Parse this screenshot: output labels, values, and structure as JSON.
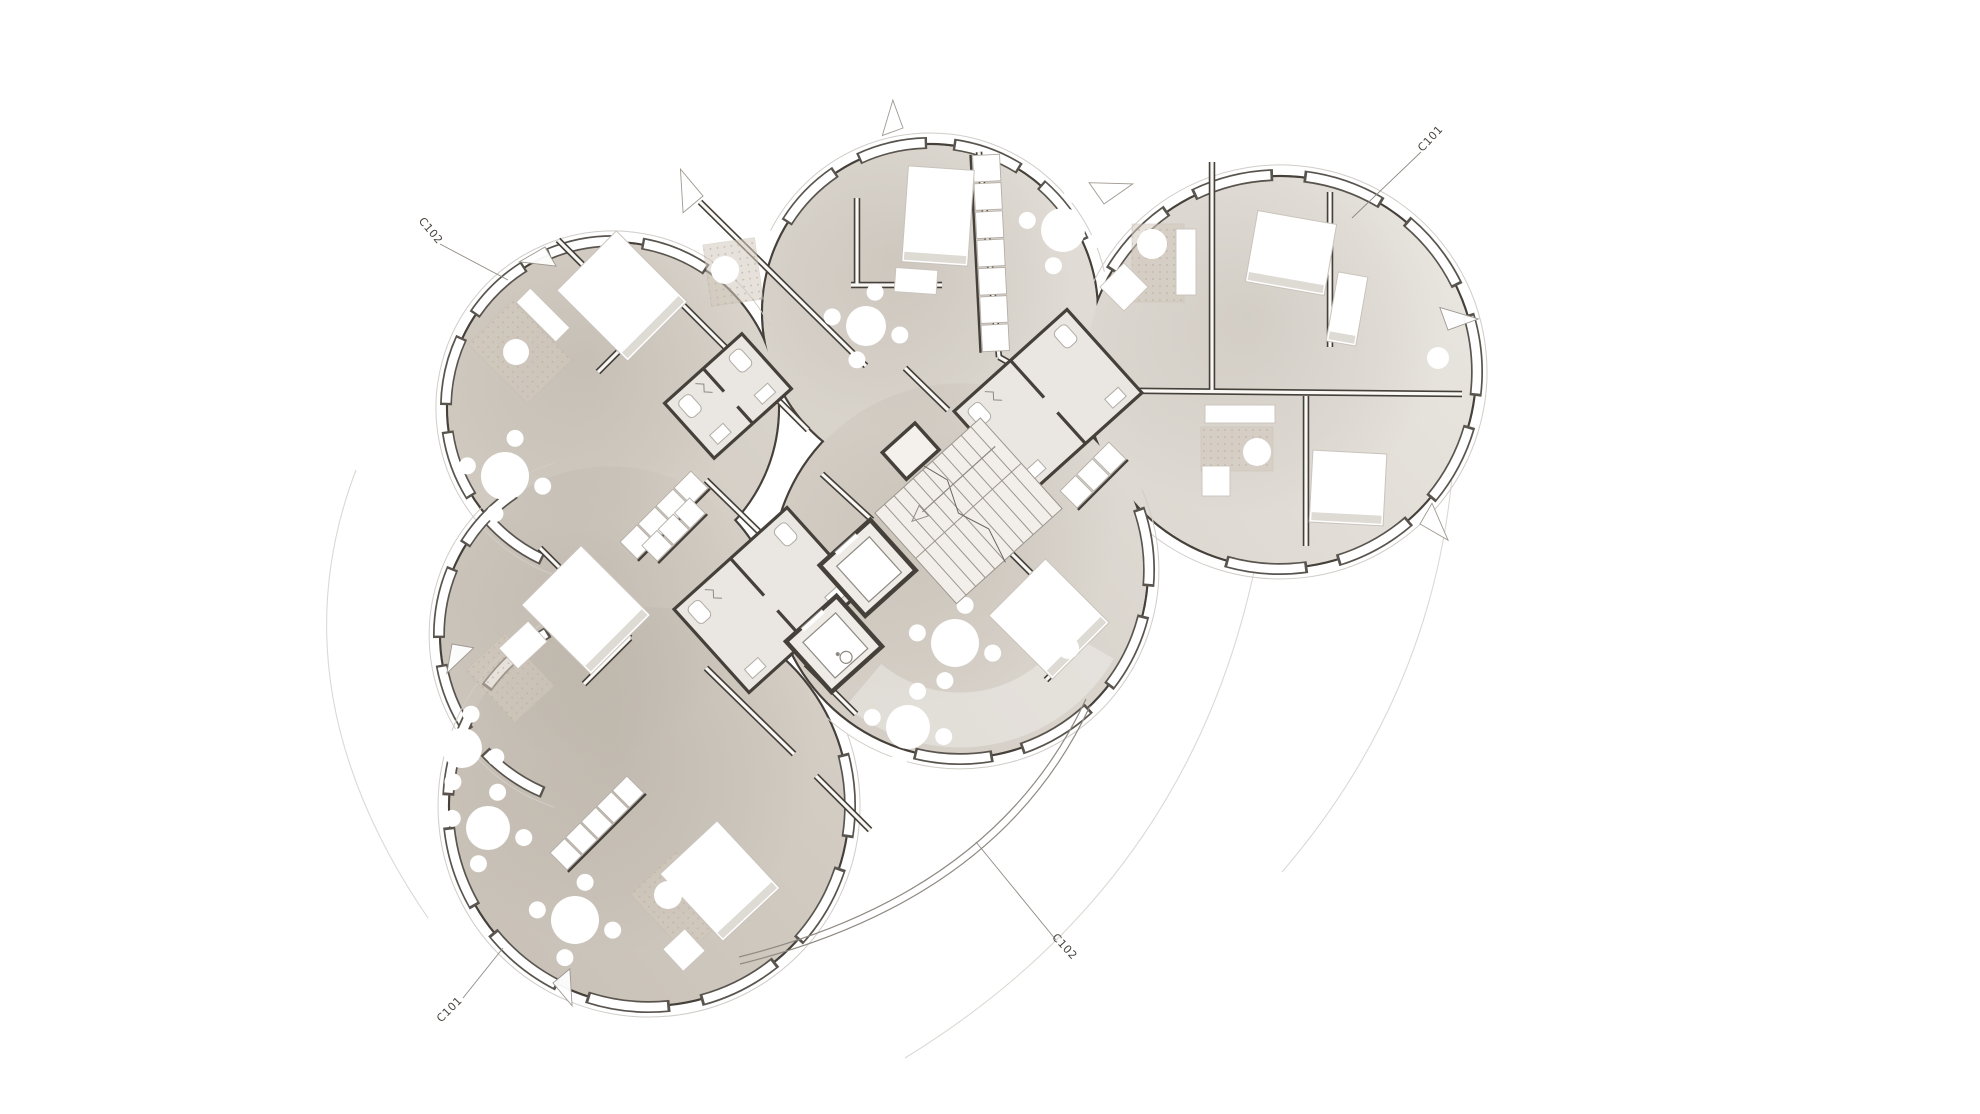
{
  "drawing": {
    "type": "architectural-floor-plan",
    "callouts": [
      {
        "text": "C101",
        "x": 1433,
        "y": 141,
        "rot": -47,
        "leader": [
          1352,
          218,
          1421,
          152
        ]
      },
      {
        "text": "C102",
        "x": 428,
        "y": 233,
        "rot": 50,
        "leader": [
          440,
          244,
          508,
          280
        ]
      },
      {
        "text": "C101",
        "x": 452,
        "y": 1012,
        "rot": -45,
        "leader": [
          463,
          998,
          503,
          948
        ]
      },
      {
        "text": "C102",
        "x": 1062,
        "y": 949,
        "rot": 47,
        "leader": [
          976,
          842,
          1056,
          940
        ]
      }
    ],
    "colors": {
      "wall": "#45403a",
      "line": "#8f8a83",
      "floor_dark": "#c4bcb1",
      "floor_light": "#ece9e4",
      "white": "#ffffff",
      "carpet": "#d3cabe",
      "carpet_dot": "#b8ad9c",
      "ghost": "#dcd9d4",
      "furniture_stroke": "#c9c3bb",
      "fixture_stroke": "#b2aca4",
      "bath_floor": "#eae6e1",
      "wall_fill": "#faf8f4",
      "outer_ring": "#d0cdc8",
      "text": "#4a4540"
    },
    "pods": [
      {
        "cx": 613,
        "cy": 408,
        "r": 166,
        "exp": [
          110,
          332
        ]
      },
      {
        "cx": 930,
        "cy": 312,
        "r": 168,
        "exp": [
          207,
          347
        ]
      },
      {
        "cx": 1280,
        "cy": 372,
        "r": 196,
        "exp": [
          206,
          492
        ]
      },
      {
        "cx": 610,
        "cy": 635,
        "r": 170,
        "exp": [
          108,
          252
        ]
      },
      {
        "cx": 649,
        "cy": 806,
        "r": 200,
        "exp": [
          340,
          600
        ]
      },
      {
        "cx": 960,
        "cy": 570,
        "r": 188,
        "exp": [
          336,
          496
        ]
      }
    ],
    "commons_glow": {
      "cx": 960,
      "cy": 570,
      "r": 150,
      "start": 30,
      "end": 130
    },
    "walls": [
      [
        700,
        202,
        866,
        366
      ],
      [
        640,
        262,
        728,
        350
      ],
      [
        752,
        374,
        808,
        430
      ],
      [
        558,
        240,
        644,
        326
      ],
      [
        644,
        326,
        598,
        372
      ],
      [
        857,
        198,
        857,
        285
      ],
      [
        851,
        285,
        942,
        285
      ],
      [
        905,
        368,
        948,
        410
      ],
      [
        979,
        152,
        999,
        357
      ],
      [
        999,
        357,
        1058,
        390
      ],
      [
        1058,
        390,
        1462,
        394
      ],
      [
        1212,
        162,
        1212,
        392
      ],
      [
        1306,
        396,
        1306,
        546
      ],
      [
        1330,
        192,
        1330,
        347
      ],
      [
        948,
        468,
        1010,
        416
      ],
      [
        822,
        474,
        872,
        520
      ],
      [
        776,
        518,
        826,
        564
      ],
      [
        706,
        480,
        788,
        560
      ],
      [
        540,
        548,
        630,
        638
      ],
      [
        630,
        638,
        584,
        684
      ],
      [
        706,
        668,
        794,
        754
      ],
      [
        816,
        776,
        870,
        830
      ],
      [
        996,
        538,
        1092,
        634
      ],
      [
        1092,
        634,
        1046,
        680
      ],
      [
        806,
        664,
        856,
        714
      ]
    ],
    "wardrobes": [
      [
        986,
        154,
        996,
        352,
        7,
        27
      ],
      [
        628,
        551,
        700,
        479,
        4,
        24
      ],
      [
        558,
        862,
        636,
        784,
        5,
        24
      ],
      [
        649,
        554,
        698,
        505,
        3,
        22
      ],
      [
        1068,
        500,
        1118,
        450,
        3,
        24
      ]
    ],
    "beds": [
      [
        622,
        296,
        84,
        100,
        -45
      ],
      [
        938,
        216,
        66,
        96,
        4
      ],
      [
        1291,
        253,
        80,
        72,
        10
      ],
      [
        1347,
        309,
        30,
        70,
        10
      ],
      [
        1348,
        488,
        74,
        72,
        3
      ],
      [
        586,
        610,
        84,
        98,
        -45
      ],
      [
        720,
        881,
        78,
        92,
        -43
      ],
      [
        1049,
        619,
        80,
        90,
        -45
      ]
    ],
    "desks": [
      [
        543,
        315,
        20,
        56,
        -45
      ],
      [
        1186,
        262,
        20,
        66,
        0
      ],
      [
        1240,
        414,
        70,
        18,
        0
      ],
      [
        1216,
        481,
        28,
        30,
        0
      ],
      [
        916,
        281,
        42,
        24,
        4
      ],
      [
        684,
        950,
        30,
        30,
        -43
      ],
      [
        523,
        645,
        40,
        28,
        -43
      ],
      [
        1124,
        287,
        34,
        34,
        45
      ]
    ],
    "tables": [
      [
        1063,
        230,
        22
      ],
      [
        866,
        326,
        20
      ],
      [
        505,
        476,
        24
      ],
      [
        488,
        828,
        22
      ],
      [
        575,
        920,
        24
      ],
      [
        955,
        643,
        24
      ],
      [
        908,
        727,
        22
      ],
      [
        462,
        748,
        20
      ],
      [
        725,
        270,
        14
      ],
      [
        1152,
        244,
        15
      ],
      [
        1257,
        452,
        14
      ],
      [
        1438,
        358,
        11
      ],
      [
        668,
        895,
        14
      ],
      [
        516,
        352,
        13
      ],
      [
        1068,
        648,
        11
      ]
    ],
    "carpets": [
      [
        733,
        272,
        52,
        62,
        -8
      ],
      [
        520,
        352,
        62,
        84,
        -45
      ],
      [
        1158,
        263,
        52,
        78,
        0
      ],
      [
        1237,
        449,
        72,
        44,
        0
      ],
      [
        681,
        903,
        62,
        82,
        -43
      ],
      [
        510,
        678,
        54,
        72,
        -43
      ]
    ],
    "bathrooms": [
      [
        1048,
        402,
        152,
        112,
        -42
      ],
      [
        768,
        600,
        152,
        112,
        -42
      ],
      [
        728,
        396,
        104,
        74,
        -42
      ]
    ],
    "door_wedges": [
      [
        703,
        196,
        140,
        26
      ],
      [
        1104,
        204,
        235,
        26
      ],
      [
        1448,
        330,
        250,
        24
      ],
      [
        1420,
        524,
        300,
        24
      ],
      [
        545,
        247,
        60,
        22
      ],
      [
        452,
        644,
        10,
        22
      ],
      [
        553,
        983,
        320,
        22
      ],
      [
        903,
        128,
        160,
        22
      ]
    ],
    "core": {
      "cx": 885,
      "cy": 590,
      "rot": -42
    },
    "railing": [
      "M1090,706 Q1000,900 740,964",
      "M1086,699 Q996,893 739,957"
    ],
    "ghost_arcs": [
      "M1258,552 Q1195,880 905,1058",
      "M1452,478 Q1430,700 1282,872",
      "M356,470 Q272,690 428,918",
      "M737,962 Q640,1002 552,972"
    ]
  }
}
